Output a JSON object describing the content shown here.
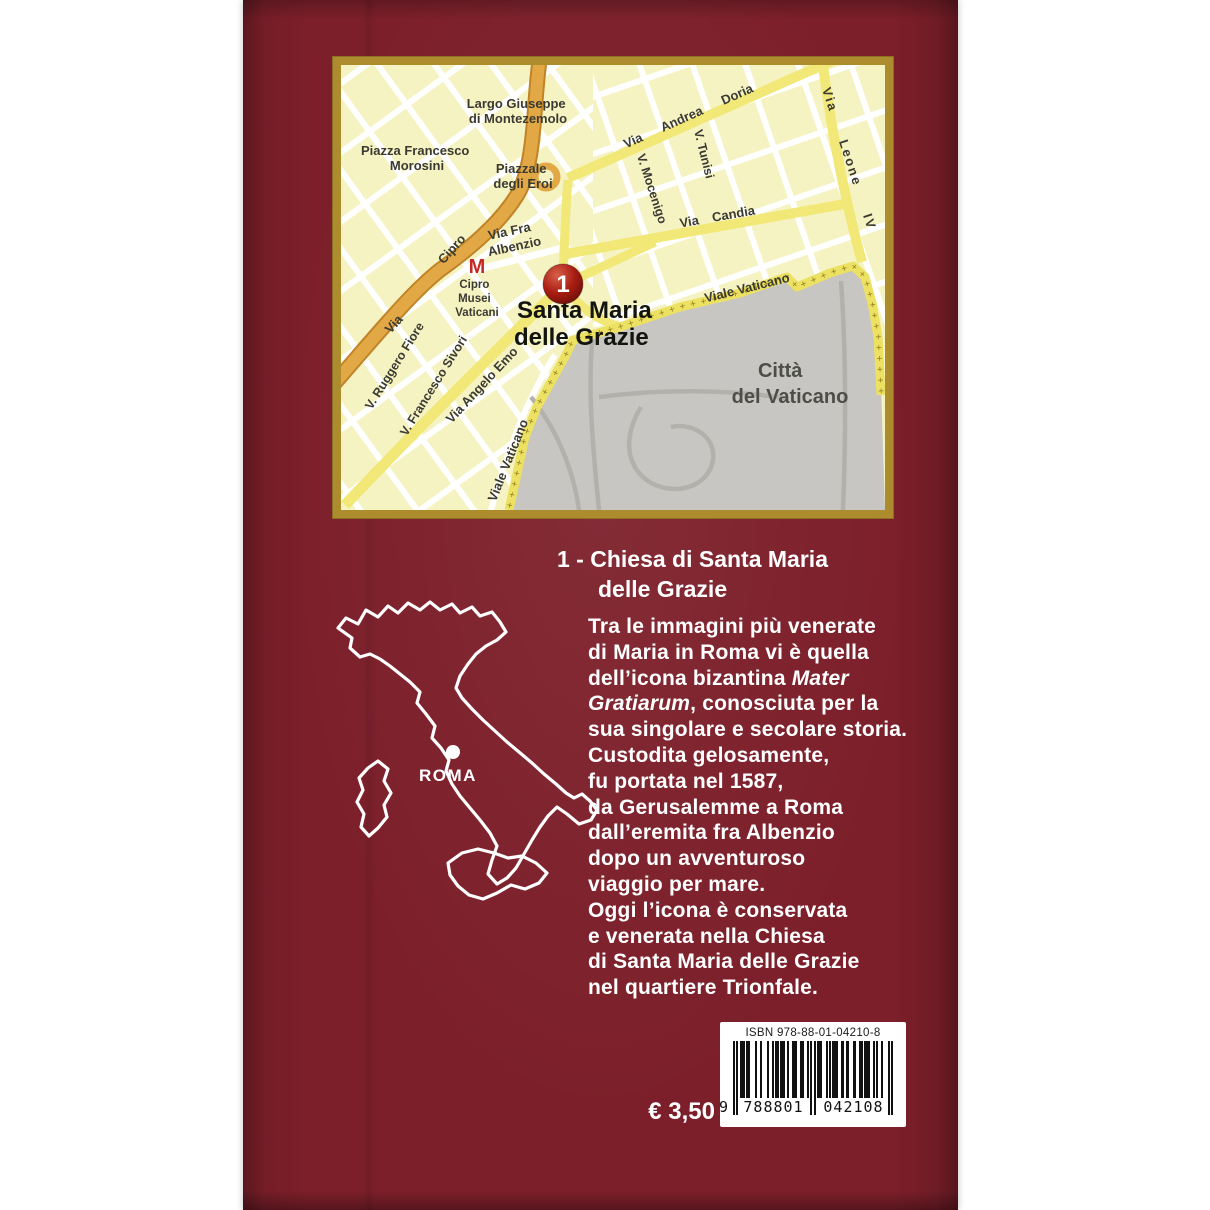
{
  "cover": {
    "background_color": "#7c1f2a",
    "frame_color": "#ad8c2d"
  },
  "map": {
    "marker": {
      "number": "1"
    },
    "labels": {
      "largo_line1": "Largo Giuseppe",
      "largo_line2": "di Montezemolo",
      "piazza_line1": "Piazza Francesco",
      "piazza_line2": "Morosini",
      "piazzale_line1": "Piazzale",
      "piazzale_line2": "degli Eroi",
      "via_andrea_doria": "Via Andrea Doria",
      "via_leone_iv": "Via Leone IV",
      "via_candia": "Via Candia",
      "v_mocenigo": "V. Mocenigo",
      "v_tunisi": "V. Tunisi",
      "via_fra_line1": "Via Fra",
      "via_fra_line2": "Albenzio",
      "via_cipro_word1": "Cipro",
      "via_cipro_word2": "Via",
      "metro_symbol": "M",
      "metro_line1": "Cipro",
      "metro_line2": "Musei",
      "metro_line3": "Vaticani",
      "poi_line1": "Santa Maria",
      "poi_line2": "delle Grazie",
      "viale_vaticano_upper": "Viale Vaticano",
      "viale_vaticano_lower": "Viale Vaticano",
      "citta_line1": "Città",
      "citta_line2": "del Vaticano",
      "v_ruggero_fiore": "V. Ruggero Fiore",
      "v_francesco_sivori": "V. Francesco Sivori",
      "via_angelo_emo": "Via Angelo Emo"
    }
  },
  "italy": {
    "city_label": "ROMA"
  },
  "section": {
    "title_line1": "1 - Chiesa di Santa Maria",
    "title_line2": "delle Grazie"
  },
  "body": {
    "lines": [
      [
        {
          "t": "Tra le immagini più venerate"
        }
      ],
      [
        {
          "t": "di Maria in Roma vi è quella"
        }
      ],
      [
        {
          "t": "dell’icona bizantina "
        },
        {
          "t": "Mater",
          "i": true
        }
      ],
      [
        {
          "t": "Gratiarum",
          "i": true
        },
        {
          "t": ", conosciuta per la"
        }
      ],
      [
        {
          "t": "sua singolare e secolare storia."
        }
      ],
      [
        {
          "t": "Custodita gelosamente,"
        }
      ],
      [
        {
          "t": "fu portata nel 1587,"
        }
      ],
      [
        {
          "t": "da Gerusalemme a Roma"
        }
      ],
      [
        {
          "t": "dall’eremita fra Albenzio"
        }
      ],
      [
        {
          "t": "dopo un avventuroso"
        }
      ],
      [
        {
          "t": "viaggio per mare."
        }
      ],
      [
        {
          "t": "Oggi l’icona è conservata"
        }
      ],
      [
        {
          "t": "e venerata nella Chiesa"
        }
      ],
      [
        {
          "t": "di Santa Maria delle Grazie"
        }
      ],
      [
        {
          "t": "nel quartiere Trionfale."
        }
      ]
    ]
  },
  "price": {
    "label": "€ 3,50"
  },
  "barcode": {
    "isbn_text": "ISBN 978-88-01-04210-8",
    "digit_lead": "9",
    "digits_group1": "788801",
    "digits_group2": "042108",
    "ean_pattern": "10101110110001001000100101101110100111001100101010111001010111001101100110011011100101001000101"
  }
}
